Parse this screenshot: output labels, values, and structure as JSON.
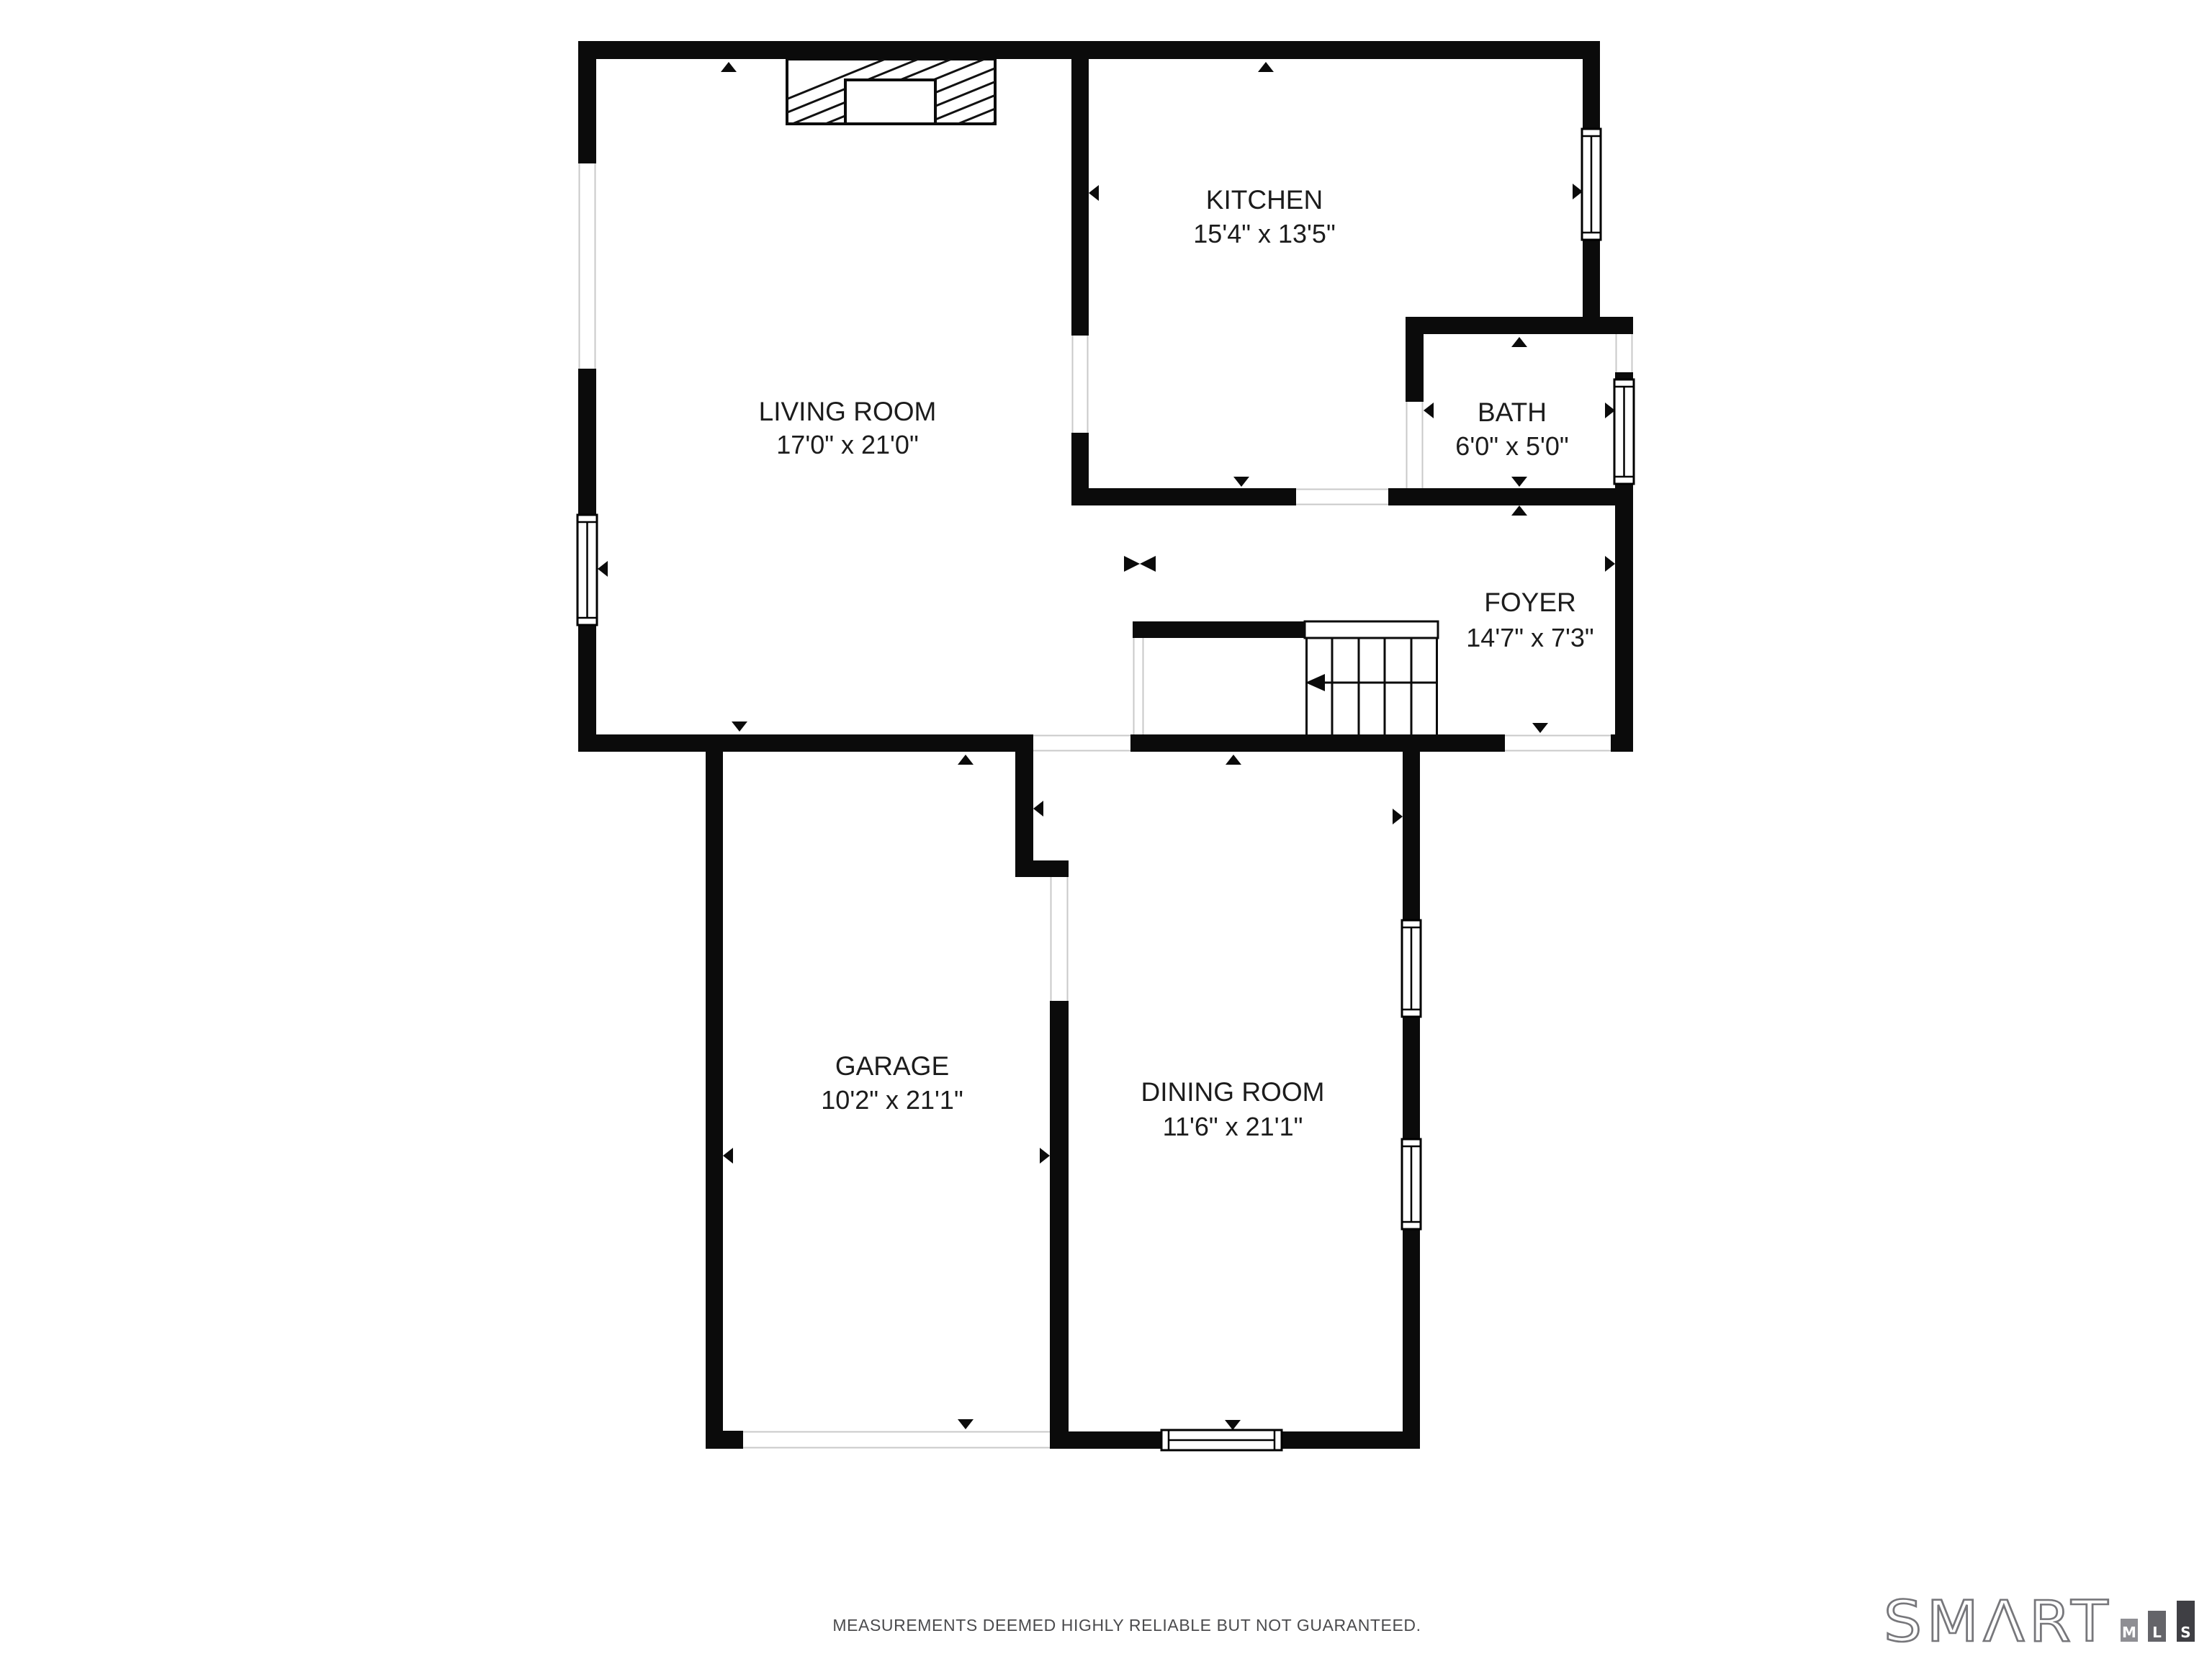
{
  "floorplan": {
    "wall_color": "#0b0b0b",
    "opening_line_color": "#c9c9c9",
    "rooms": [
      {
        "id": "living",
        "name": "LIVING ROOM",
        "dims": "17'0\" x 21'0\""
      },
      {
        "id": "kitchen",
        "name": "KITCHEN",
        "dims": "15'4\" x 13'5\""
      },
      {
        "id": "bath",
        "name": "BATH",
        "dims": "6'0\" x 5'0\""
      },
      {
        "id": "foyer",
        "name": "FOYER",
        "dims": "14'7\" x 7'3\""
      },
      {
        "id": "garage",
        "name": "GARAGE",
        "dims": "10'2\" x 21'1\""
      },
      {
        "id": "dining",
        "name": "DINING ROOM",
        "dims": "11'6\" x 21'1\""
      }
    ],
    "features": [
      "fireplace",
      "stairs",
      "windows",
      "door-openings",
      "measurement-arrows"
    ]
  },
  "footer": {
    "disclaimer": "MEASUREMENTS DEEMED HIGHLY RELIABLE BUT NOT GUARANTEED."
  },
  "logo": {
    "brand": "SMART",
    "display": "SMΛRT",
    "bars": [
      {
        "letter": "M",
        "color": "#8e8e93"
      },
      {
        "letter": "L",
        "color": "#646469"
      },
      {
        "letter": "S",
        "color": "#3f3f44"
      }
    ]
  }
}
